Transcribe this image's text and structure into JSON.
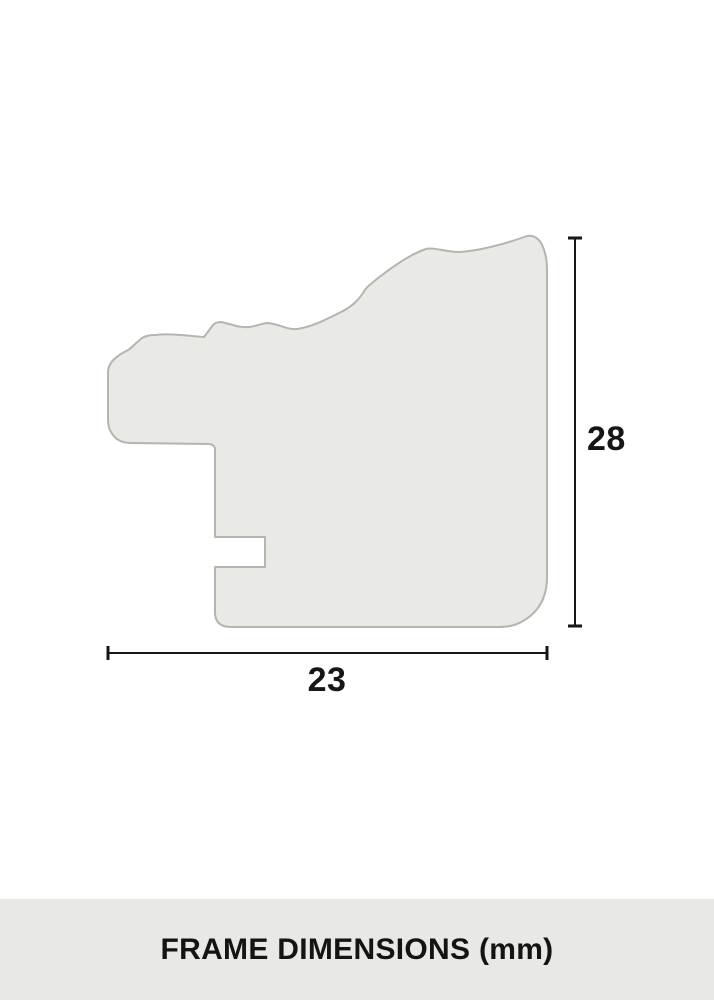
{
  "diagram": {
    "type": "frame-moulding-cross-section",
    "height_dimension": "28",
    "width_dimension": "23",
    "caption": "FRAME DIMENSIONS (mm)",
    "units": "mm"
  },
  "colors": {
    "page_background": "#ffffff",
    "profile_fill": "#e9e9e5",
    "profile_stroke": "#b5b5b0",
    "dimension_line": "#161616",
    "label_text": "#161616",
    "caption_background": "#e8e8e4",
    "caption_text": "#141414"
  }
}
